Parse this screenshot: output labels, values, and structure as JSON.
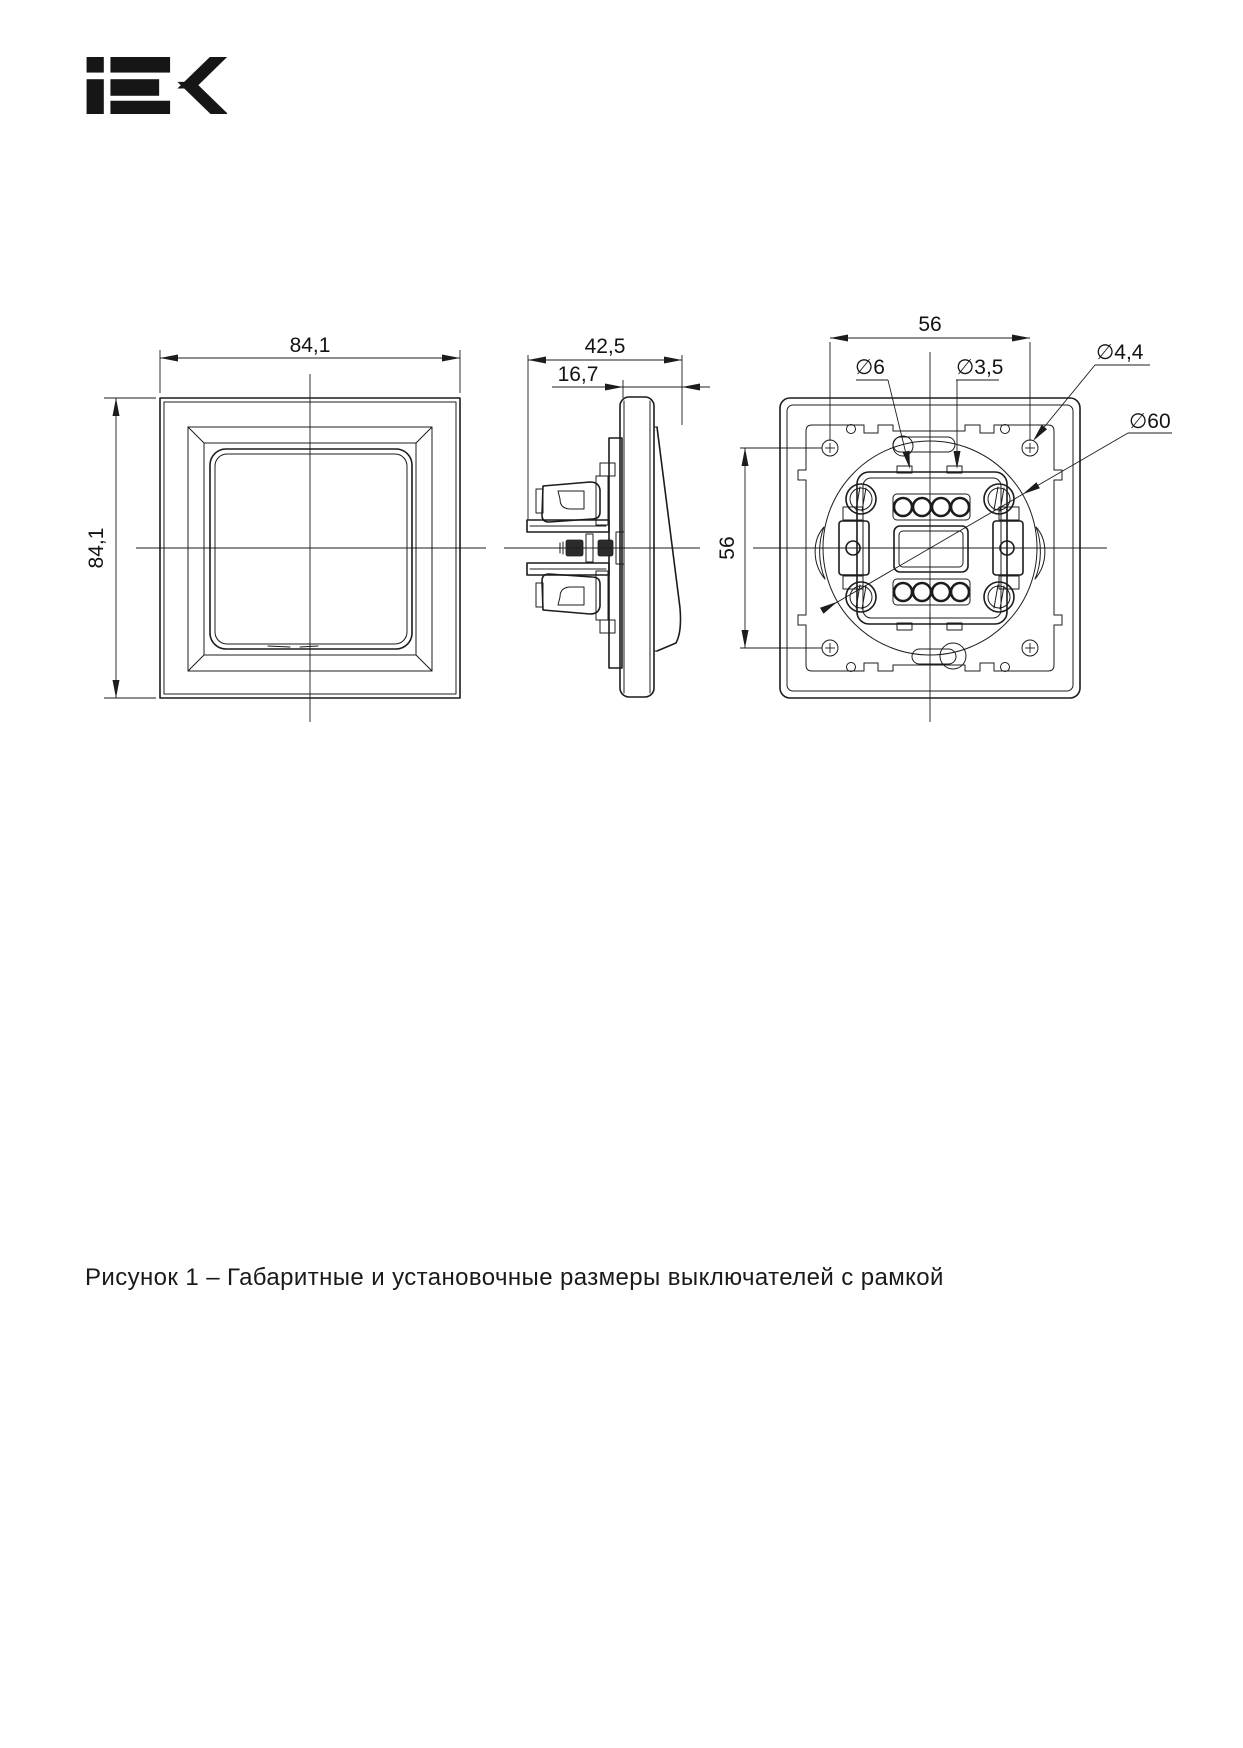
{
  "logo": {
    "brand": "IEK"
  },
  "caption": "Рисунок 1 – Габаритные и установочные размеры выключателей с рамкой",
  "dims": {
    "front_width": "84,1",
    "front_height": "84,1",
    "side_depth": "42,5",
    "side_protrusion": "16,7",
    "back_hole_spacing_h": "56",
    "back_hole_spacing_v": "56",
    "dia_wire_hole": "∅6",
    "dia_fixing_hole": "∅3,5",
    "dia_screw_hole": "∅4,4",
    "dia_mounting_circle": "∅60"
  },
  "colors": {
    "line": "#1c1c1c",
    "background": "#ffffff"
  }
}
